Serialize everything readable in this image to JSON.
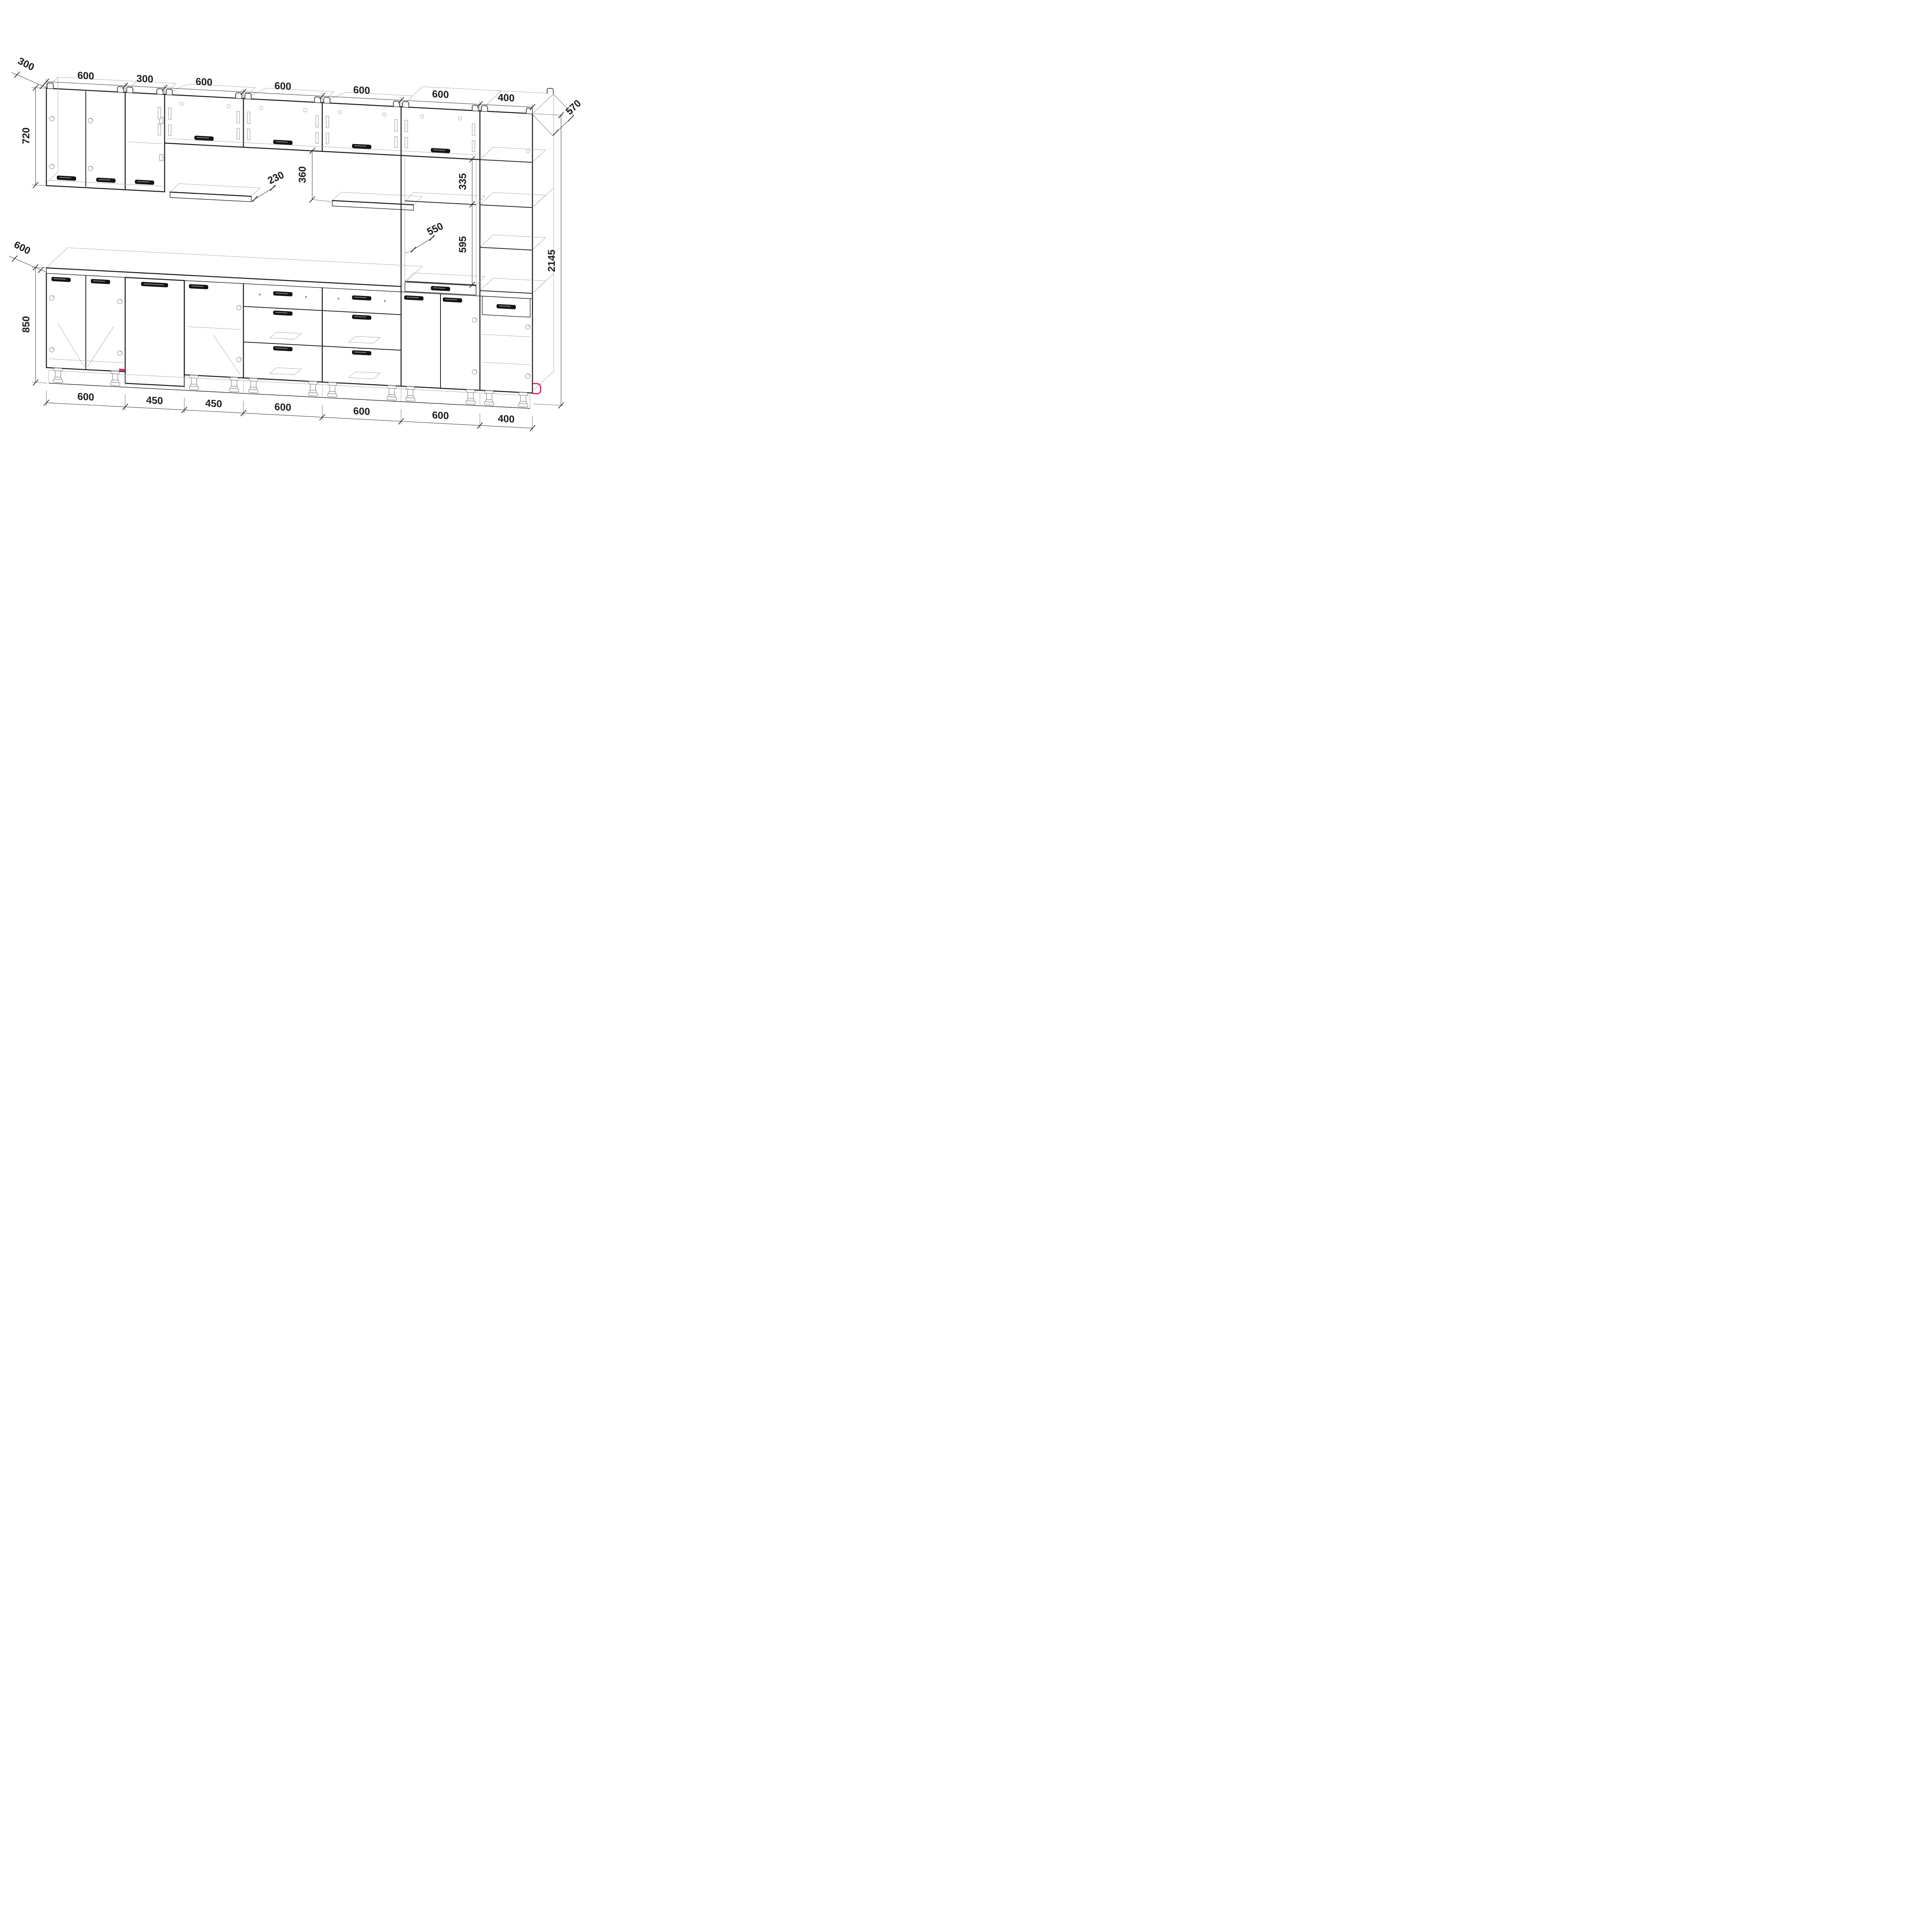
{
  "drawing": {
    "type": "kitchen-cabinet-elevation",
    "units": "mm",
    "dims": {
      "top": [
        "600",
        "300",
        "600",
        "600",
        "600",
        "600",
        "400"
      ],
      "bottom": [
        "600",
        "450",
        "450",
        "600",
        "600",
        "600",
        "400"
      ],
      "upper_depth": "300",
      "upper_height": "720",
      "shelf_depth": "230",
      "wall_gap": "360",
      "niche_top": "335",
      "oven_depth": "550",
      "oven_niche": "595",
      "total_height": "2145",
      "tall_depth": "570",
      "base_depth": "600",
      "base_height": "850"
    },
    "colors": {
      "line": "#1d1d1b",
      "light_line": "#a9a9a7",
      "dim_line": "#3a3a38",
      "accent": "#e5175e",
      "background": "#ffffff"
    }
  }
}
